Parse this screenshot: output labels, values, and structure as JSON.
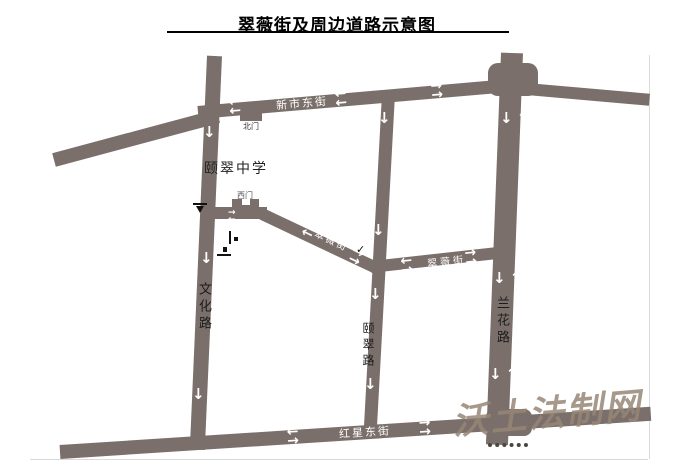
{
  "title": "翠薇街及周边道路示意图",
  "school": {
    "name": "颐翠中学",
    "north_gate": "北门",
    "west_gate": "西门"
  },
  "roads": {
    "xinshi_east_street": "新市东街",
    "cuiwei_street": "翠薇街",
    "wenhua_road": "文化路",
    "yicui_road": "颐翠路",
    "lanhua_road": "兰花路",
    "hongxing_east_street": "红星东街"
  },
  "watermark": {
    "text": "沃土法制网"
  },
  "colors": {
    "road": "#7a6f6a",
    "street_label_light": "#ffffff",
    "road_label_dark": "#1c1c1c",
    "watermark": "#968677"
  },
  "icons": {
    "arrow_up": "↑",
    "arrow_down": "↓",
    "arrow_left": "←",
    "arrow_right": "→",
    "check_mark": "✓"
  }
}
